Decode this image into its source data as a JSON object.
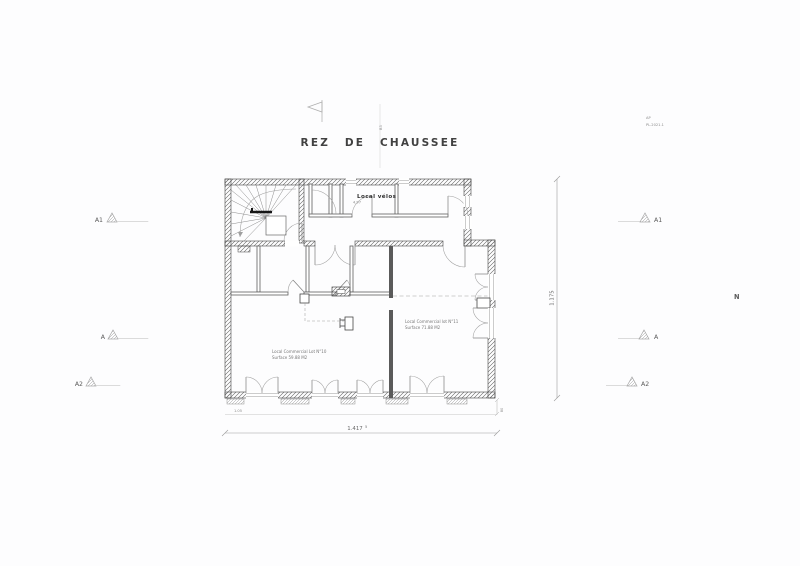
{
  "header": {
    "title": "REZ DE CHAUSSEE",
    "grid_marker": "B3",
    "stamp_line1": "AP",
    "stamp_line2": "PL.2021.1"
  },
  "north_label": "N",
  "rooms": {
    "velos": {
      "name": "Local vélos",
      "area": "4.97"
    },
    "lot10": {
      "line1": "Local Commercial Lot N°10",
      "line2": "Surface 59.88 M2"
    },
    "lot11": {
      "line1": "Local Commercial lot N°11",
      "line2": "Surface 71.88 M2"
    }
  },
  "dimensions": {
    "overall_width": "1.417",
    "overall_width_sup": "5",
    "overall_height": "1.175",
    "right_offset": "80",
    "left_inset": "1.05"
  },
  "sections": {
    "left": [
      "A1",
      "A",
      "A2"
    ],
    "right": [
      "A1",
      "A",
      "A2"
    ]
  },
  "colors": {
    "wall": "#4a4a4a",
    "thin_line": "#8a8a8a",
    "dim_line": "#9a9a9a",
    "text_dark": "#414141"
  }
}
